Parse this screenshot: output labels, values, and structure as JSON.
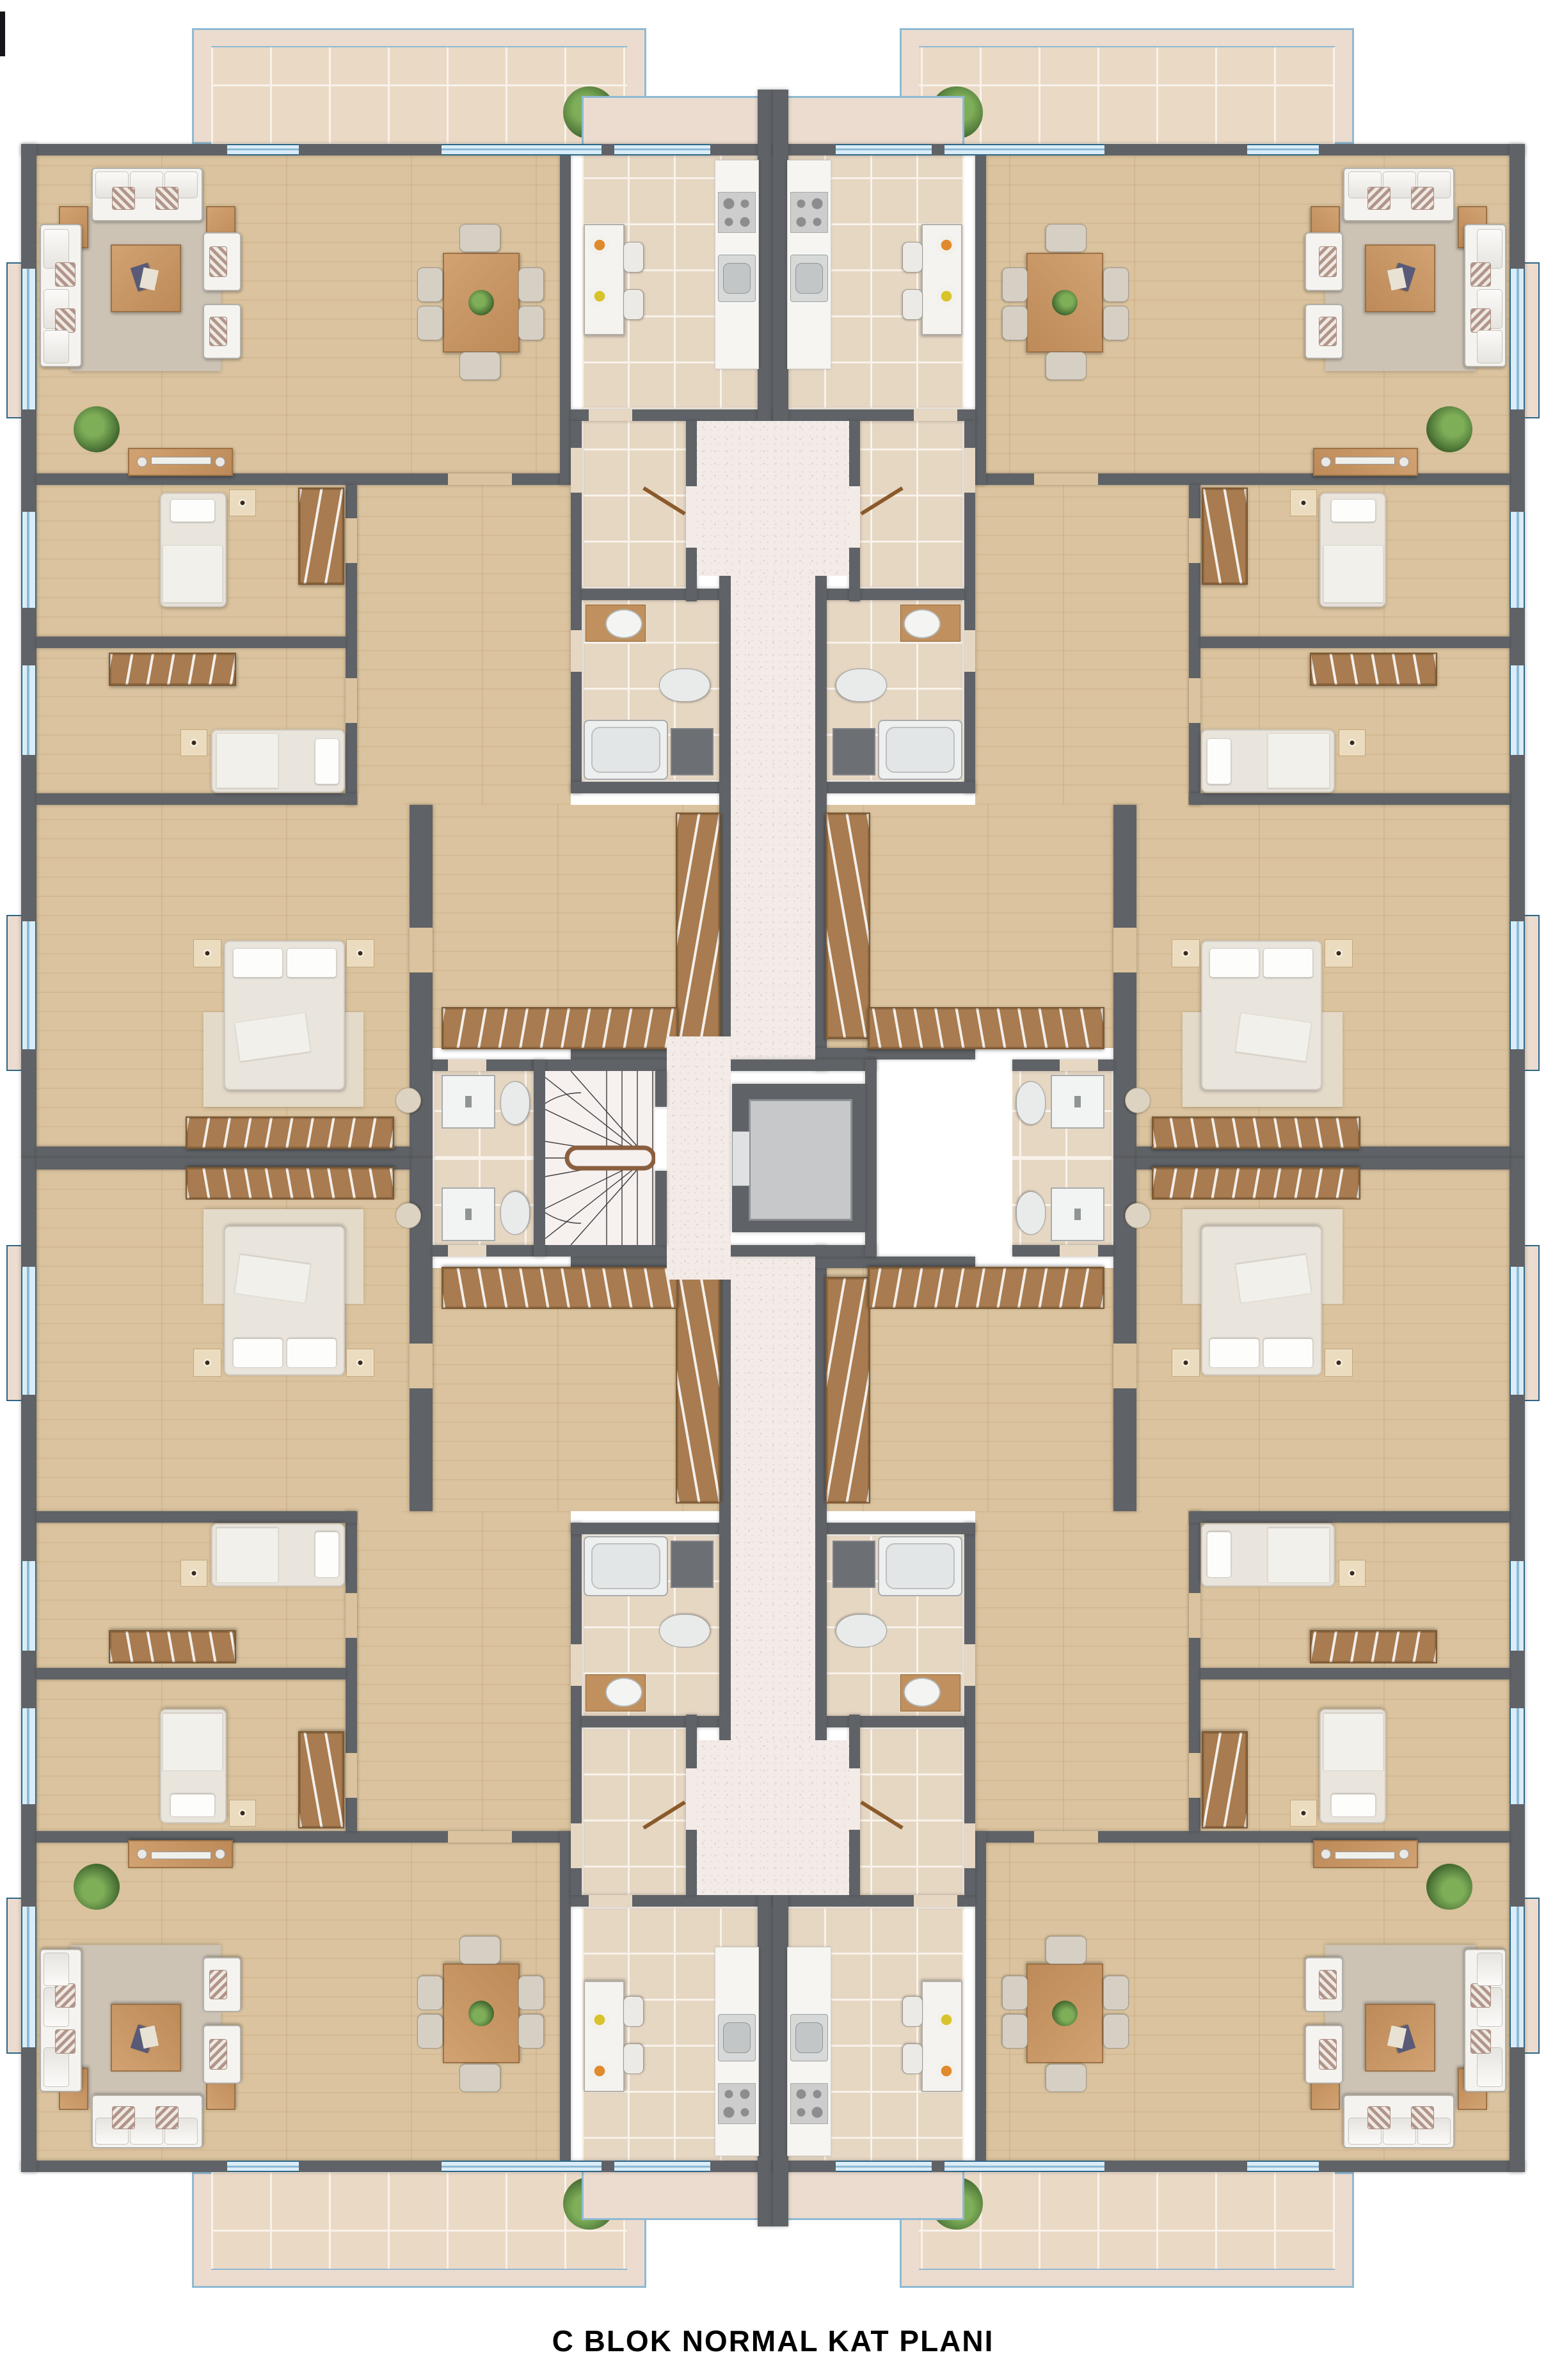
{
  "title": {
    "caption": "C BLOK NORMAL KAT PLANI"
  },
  "plan": {
    "block": "C",
    "drawing_type": "normal-floor-plan",
    "apartments_per_floor": 4,
    "core_elements": [
      "staircase",
      "elevator",
      "corridor"
    ],
    "apartment_rooms": [
      "living-room",
      "dining-area",
      "kitchen",
      "kitchen-balcony",
      "living-balcony",
      "bedroom-1",
      "bedroom-2",
      "master-bedroom",
      "dressing-room",
      "bathroom",
      "master-bathroom",
      "entry-hall"
    ]
  },
  "palette": {
    "wall": "#5f6266",
    "wood": "#dac39e",
    "tile": "#e6d7c3",
    "grout": "#f8f2ea",
    "corridor": "#f3ebe7",
    "corridor_dot": "#e2d3cc",
    "balcony_band": "#ecdccf",
    "balcony_tile": "#ead9c5",
    "rail_blue": "#8fb9d4",
    "rail_frame": "#2e6687",
    "rug": "#cdc3b5",
    "rug_bed": "#e4dac9",
    "white_furn": "#f4f3ef",
    "furn_border": "#b3b0a9",
    "wardrobe": "#a87c50",
    "wardrobe_dark": "#7c5833",
    "counter": "#f6f5f2",
    "shaft": "#6c6f73",
    "elevator": "#c6c8ca",
    "stair_floor": "#f6f0ef",
    "door": "#8b5a2b",
    "plant_green": "#598340",
    "fruit_orange": "#e08a2d",
    "fruit_yellow": "#d8c32a",
    "caption_color": "#000000"
  }
}
